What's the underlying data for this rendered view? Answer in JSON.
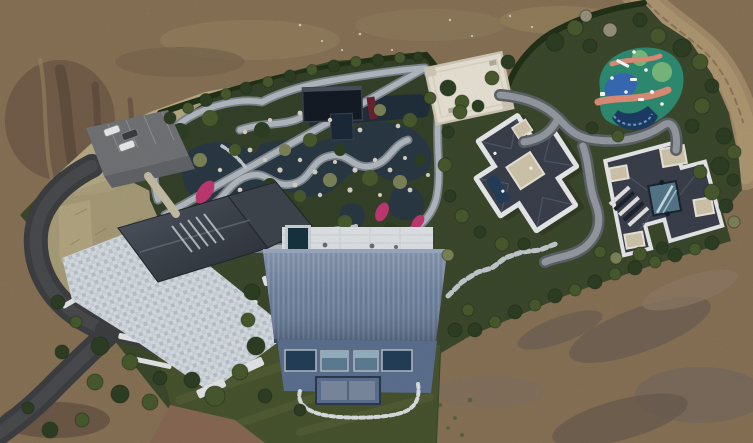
{
  "scene": {
    "type": "aerial-drone-photo",
    "subject": "landscaped estate compound with garden ponds, villas, plaza, playground and dirt surroundings",
    "car_count": 3
  },
  "colors": {
    "dirt_base": "#8a7457",
    "dirt_light": "#9a8465",
    "dirt_dark": "#6a5745",
    "dirt_gray": "#7f7164",
    "dirt_red": "#8a6a55",
    "track": "#a68e6c",
    "track_light": "#b29a74",
    "hedge": "#243219",
    "property_green": "#3d4a2d",
    "garden_bed": "#36432a",
    "lawn": "#49552f",
    "lawn_light": "#5b673c",
    "dry_grass": "#bfb28b",
    "asphalt": "#3e4043",
    "plaza": "#dce2e7",
    "left_roof": "#40464f",
    "blue_roof": "#7286a4",
    "blue_wall": "#5e7292",
    "glass": "#24405a",
    "window_lt": "#5f7f96",
    "terrace": "#e4e8eb",
    "spa": "#17343f",
    "stone": "#b6bdc4",
    "stone_edge": "#7f868e",
    "water": "#2b3a46",
    "water_dark": "#20303c",
    "pavilion": "#151c26",
    "flower": "#c43a74",
    "rock": "#dbd6c9",
    "tree_dark": "#2e4024",
    "tree_mid": "#4a5c2f",
    "tree_light": "#68783e",
    "tree_olive": "#7e8659",
    "tree_bare": "#9a947f",
    "white_roof": "#eee8da",
    "white_edge": "#d5cdbb",
    "dark_roof": "#3b414d",
    "roof_hl": "#545b69",
    "beige": "#d4caaf",
    "skylight": "#55798c",
    "play_teal": "#2f8f74",
    "play_blue": "#3a6cba",
    "play_salmon": "#e29079",
    "play_green": "#7cbd80",
    "play_navy": "#1d3e68",
    "path": "#989da4",
    "path_edge": "#5f646b",
    "white": "#eef0f1",
    "car_dark": "#3b3e43",
    "wall_white": "#e9ebec"
  }
}
